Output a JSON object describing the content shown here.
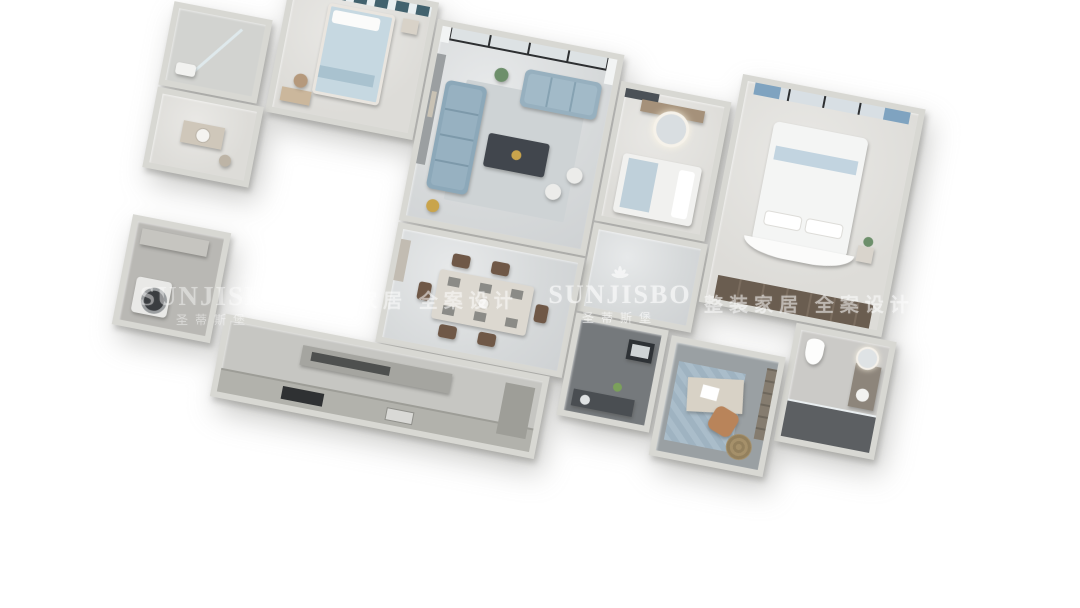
{
  "watermark": {
    "brand": "SUNJISBO",
    "brand_cn": "圣蒂斯堡",
    "slogan": "整装家居 全案设计",
    "logo_icon": "fan-flower-icon",
    "color": "#ffffff"
  },
  "scene": {
    "kind": "3d-apartment-floorplan-render",
    "style": "modern light-gray and blue interior",
    "rotation_deg": 11,
    "background": "#ffffff"
  },
  "palette": {
    "wall": "#d8d8d3",
    "floor_marble": "#d6d9da",
    "sofa_blue": "#8ca8b9",
    "curtain_teal": "#42626e",
    "curtain_blue": "#7fa3c0",
    "dark_tile": "#5c5f62",
    "wardrobe_wood": "#6a5d50",
    "chair_tan": "#b9845a"
  },
  "rooms": [
    {
      "name": "secondary-bedroom",
      "furniture": [
        "bed",
        "teal-curtains",
        "desk",
        "chair"
      ]
    },
    {
      "name": "bathroom-small",
      "furniture": [
        "shower-glass",
        "fixture"
      ]
    },
    {
      "name": "cloakroom",
      "furniture": [
        "vanity",
        "stool"
      ]
    },
    {
      "name": "living-room",
      "furniture": [
        "balcony-sliding-doors",
        "sectional-sofa",
        "loveseat",
        "coffee-table",
        "ottomans",
        "rug",
        "tv-accent-wall",
        "plant"
      ]
    },
    {
      "name": "dressing-bedroom",
      "furniture": [
        "round-lit-mirror",
        "dresser",
        "bed"
      ]
    },
    {
      "name": "hallway",
      "furniture": []
    },
    {
      "name": "master-bedroom",
      "furniture": [
        "curved-headboard-bed",
        "blue-curtain-window",
        "wardrobe",
        "nightstand",
        "plant"
      ]
    },
    {
      "name": "master-bathroom",
      "furniture": [
        "toilet",
        "vanity-round-mirror",
        "shower"
      ]
    },
    {
      "name": "dining-room",
      "furniture": [
        "dining-table",
        "six-chairs",
        "sideboard"
      ]
    },
    {
      "name": "guest-bathroom",
      "furniture": [
        "mirror-cabinet",
        "counter-sink",
        "plant"
      ]
    },
    {
      "name": "study",
      "furniture": [
        "desk",
        "task-chair",
        "blue-rug",
        "bookshelf",
        "round-woven-rug"
      ]
    },
    {
      "name": "kitchen",
      "furniture": [
        "counter-run",
        "island",
        "cooktop",
        "sink"
      ]
    },
    {
      "name": "laundry",
      "furniture": [
        "washing-machine",
        "cabinet"
      ]
    }
  ]
}
